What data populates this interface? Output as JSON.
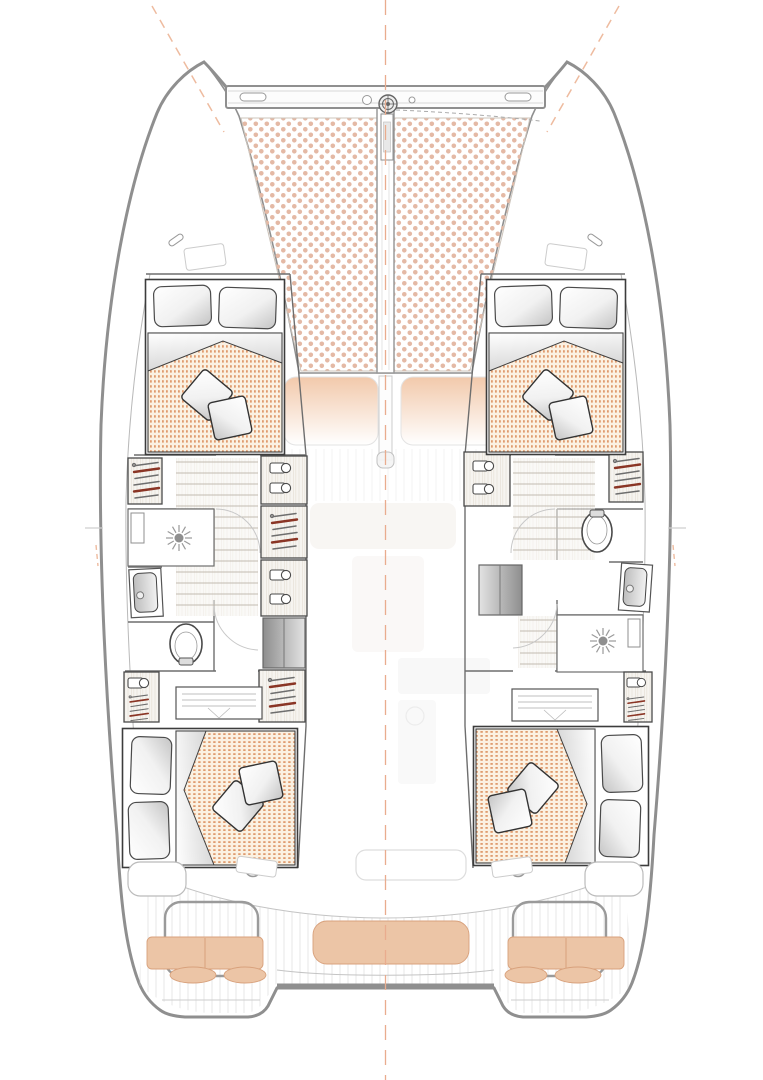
{
  "document": {
    "kind": "catamaran-interior-layout-plan-top-view",
    "visible_text": []
  },
  "palette": {
    "background": "#ffffff",
    "hull-stroke": "#8f8f8f",
    "interior-wall": "#6e6e6e",
    "furniture-stroke": "#4a4a4a",
    "bed-frame": "#3c3c3c",
    "wood-fill": "#f6f4f0",
    "wood-grain": "#e7e1d7",
    "stair-tread": "#c2bbb0",
    "trampoline-dot": "#e4b9a5",
    "duvet-bg": "#fbf1e2",
    "duvet-dot": "#dc9162",
    "cushion-tan": "#ecc5a6",
    "cushion-tan-edge": "#d8a17c",
    "seat-fade-top": "#f2c9ab",
    "hanger-accent": "#8a3525",
    "hanger-gray": "#6e6e6e",
    "steps-dark": "#8e8e8e",
    "steps-light": "#e3e3e3",
    "centerline": "#e9ac8e",
    "teak-line": "#cfcfcf",
    "faint-furniture": "#e9e0d8",
    "metal-gray": "#9a9a9a"
  },
  "components": {
    "bow": [
      "forward-crossbeam",
      "windlass",
      "anchor-roller",
      "trampoline-port-panel",
      "trampoline-starboard-panel",
      "mast-beam",
      "bow-bridle-line",
      "bow-cleats",
      "deck-hatches"
    ],
    "port_hull": {
      "forward_cabin": {
        "bed": "double",
        "pillows": 2,
        "throw_cushions": 2,
        "wardrobes": [
          "hanging-locker-outboard",
          "shelf-cabinet-inboard",
          "hanging-locker-inboard",
          "shelf-cabinet-inboard-2"
        ]
      },
      "bathroom": {
        "fixtures": [
          "shower-with-drain",
          "washbasin",
          "toilet"
        ]
      },
      "circulation": [
        "stair-treads",
        "companionway-steps",
        "door-swing-arcs"
      ],
      "aft_cabin": {
        "bed": "double",
        "pillows": 2,
        "throw_cushions": 2,
        "storage": [
          "dresser",
          "hanging-locker-outboard",
          "hanging-locker-inboard"
        ]
      }
    },
    "starboard_hull": {
      "forward_cabin": {
        "bed": "double",
        "pillows": 2,
        "throw_cushions": 2,
        "wardrobes": [
          "hanging-locker-outboard",
          "shelf-cabinet-inboard"
        ]
      },
      "bathroom": {
        "fixtures": [
          "toilet",
          "washbasin",
          "shower-with-drain"
        ]
      },
      "circulation": [
        "stair-treads",
        "companionway-steps",
        "door-swing-arcs"
      ],
      "aft_cabin": {
        "bed": "double",
        "pillows": 2,
        "throw_cushions": 2,
        "storage": [
          "dresser",
          "hanging-locker-outboard"
        ]
      }
    },
    "bridgedeck": [
      "forward-cockpit-seat-port",
      "forward-cockpit-seat-starboard",
      "saloon-faint-furniture",
      "galley-faint-outline"
    ],
    "aft_cockpit": [
      "teak-floor",
      "cockpit-table",
      "winch-port",
      "winch-starboard",
      "helm-seat-port",
      "helm-seat-starboard",
      "helm-cushions",
      "footrest-cushions",
      "stern-bench",
      "swim-platform-port",
      "swim-platform-starboard",
      "transom-bar"
    ],
    "reference": [
      "vertical-centerline",
      "rig-line-port",
      "rig-line-starboard",
      "beam-tick-port",
      "beam-tick-starboard"
    ]
  }
}
